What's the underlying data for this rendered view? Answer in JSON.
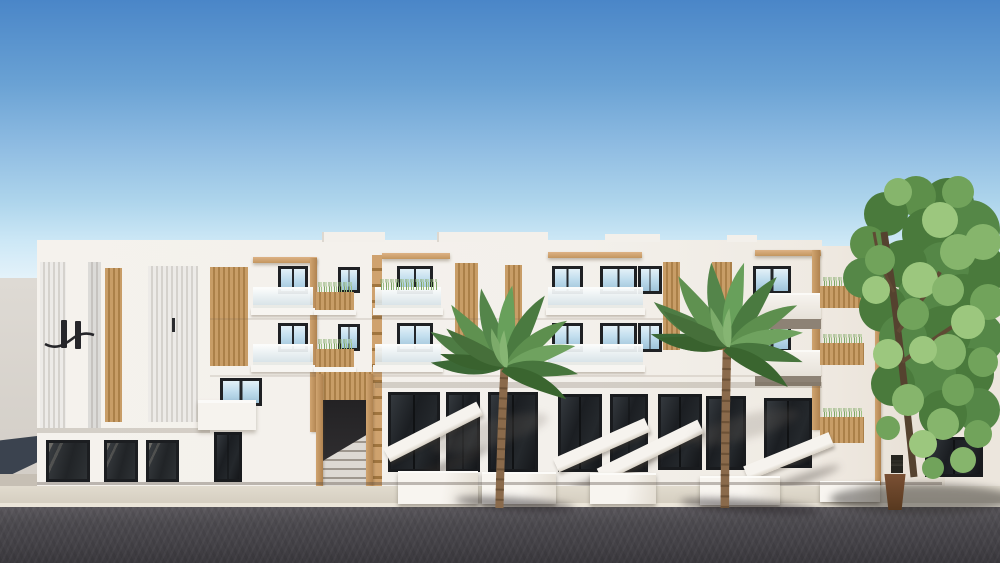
{
  "scene": {
    "description": "3D architectural rendering of a modern white apartment building with wooden slat accents, frosted glass balconies, two palm trees and a leafy green tree under a clear blue sky, fronted by a dark asphalt street",
    "logo_letter": "H"
  },
  "palette": {
    "sky-top": "#4a86c8",
    "sky-mid": "#8fbce2",
    "sky-low": "#aed5ec",
    "sky-horizon": "#cde8f6",
    "wall": "#f3f0eb",
    "wall-warm": "#e9e1d6",
    "annex": "#d9d5cf",
    "annex-shadow": "#3b434f",
    "wood": "#c89d67",
    "wood-dark": "#ab8049",
    "frame": "#1f2124",
    "glass-sky": "#c2deee",
    "glass-dark": "#1b1e22",
    "rail": "#e4ebee",
    "slab": "#f7f5f1",
    "grass": "#7fa468",
    "palm-green": "#4e7c44",
    "palm-green-dark": "#3a652f",
    "tree-green": "#5d8f4a",
    "tree-green-light": "#8fb877",
    "palm-trunk": "#8a6a4b",
    "tree-trunk": "#55422f",
    "sidewalk": "#d8d1c4",
    "curb": "#ebe5d9",
    "road": "#434146",
    "road-dark": "#3a383d",
    "planter-pot": "#6b4a33",
    "sign": "#24231f"
  }
}
